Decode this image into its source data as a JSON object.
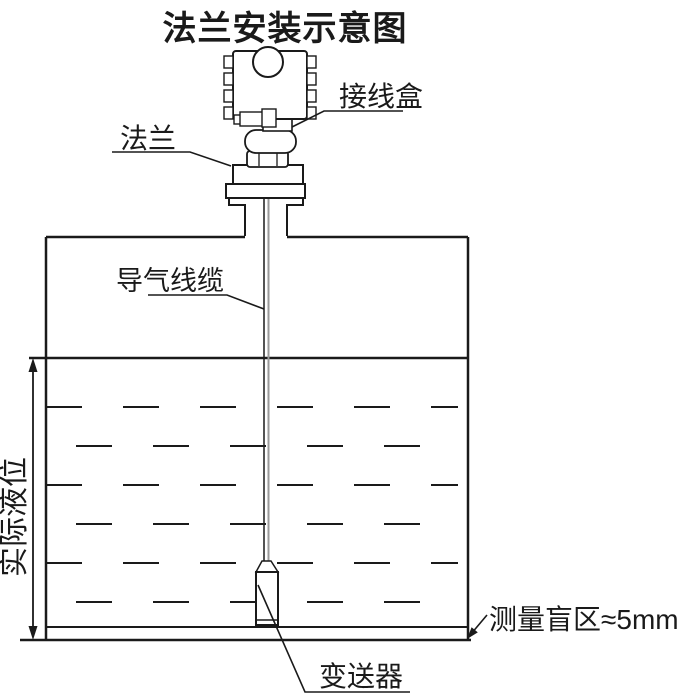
{
  "title": "法兰安装示意图",
  "labels": {
    "junction_box": "接线盒",
    "flange": "法兰",
    "air_cable": "导气线缆",
    "actual_level": "实际液位",
    "blind_zone": "测量盲区≈5mm",
    "transmitter": "变送器"
  },
  "annotations": {
    "blind_zone_value": "≈5mm"
  },
  "colors": {
    "ink": "#1a1a1a",
    "cable_gray": "#999999",
    "background": "#ffffff"
  }
}
